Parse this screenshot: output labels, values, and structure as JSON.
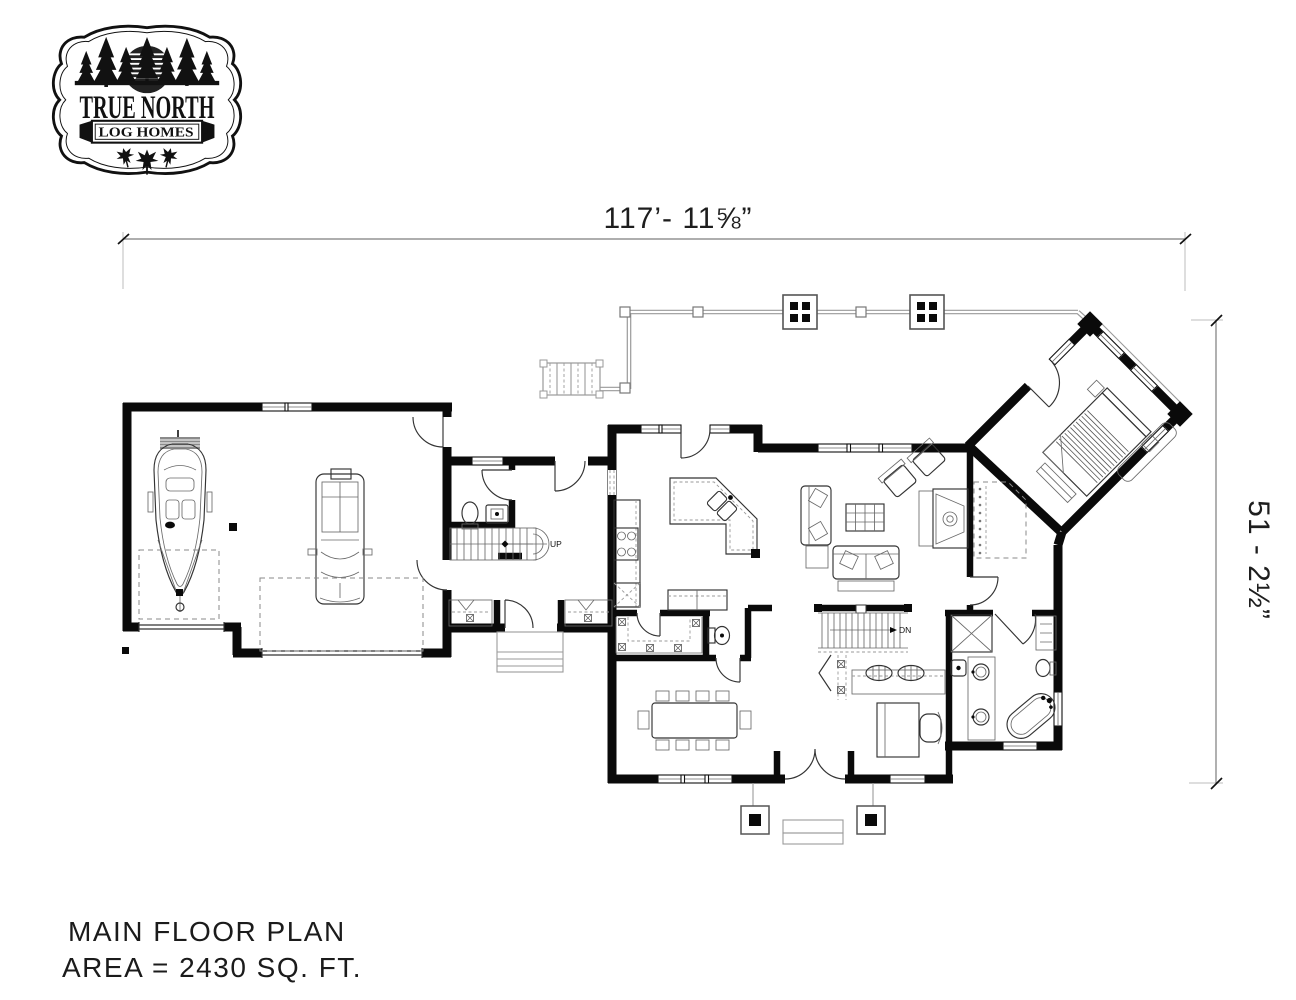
{
  "logo": {
    "title": "TRUE NORTH",
    "banner": "LOG HOMES"
  },
  "dimensions": {
    "width": "117’- 11⅝”",
    "height": "51 - 2½”"
  },
  "titleblock": {
    "line1": "MAIN FLOOR PLAN",
    "line2": "AREA = 2430 SQ. FT."
  },
  "labels": {
    "stairs_up": "UP",
    "stairs_down": "DN"
  },
  "colors": {
    "wall": "#0a0a0a",
    "thin": "#333333",
    "dim_line": "#7d7d7d",
    "ink": "#1a1a1a"
  }
}
